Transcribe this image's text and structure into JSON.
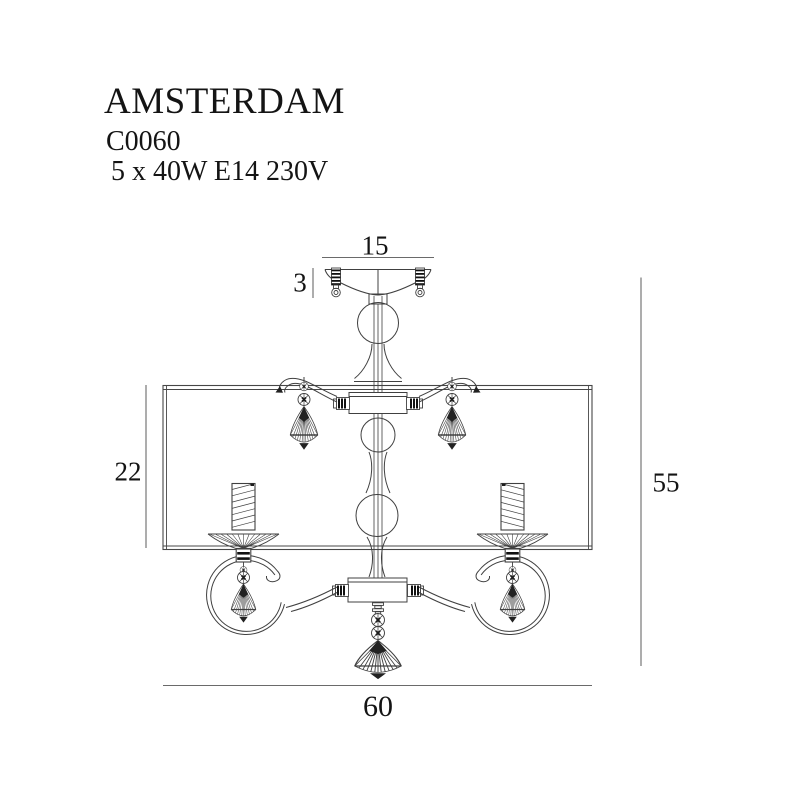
{
  "product": {
    "name": "AMSTERDAM",
    "code": "C0060",
    "spec": "5 x 40W E14 230V"
  },
  "dimensions": {
    "canopy_width": "15",
    "canopy_height": "3",
    "shade_height": "22",
    "fixture_height": "55",
    "fixture_width": "60"
  }
}
